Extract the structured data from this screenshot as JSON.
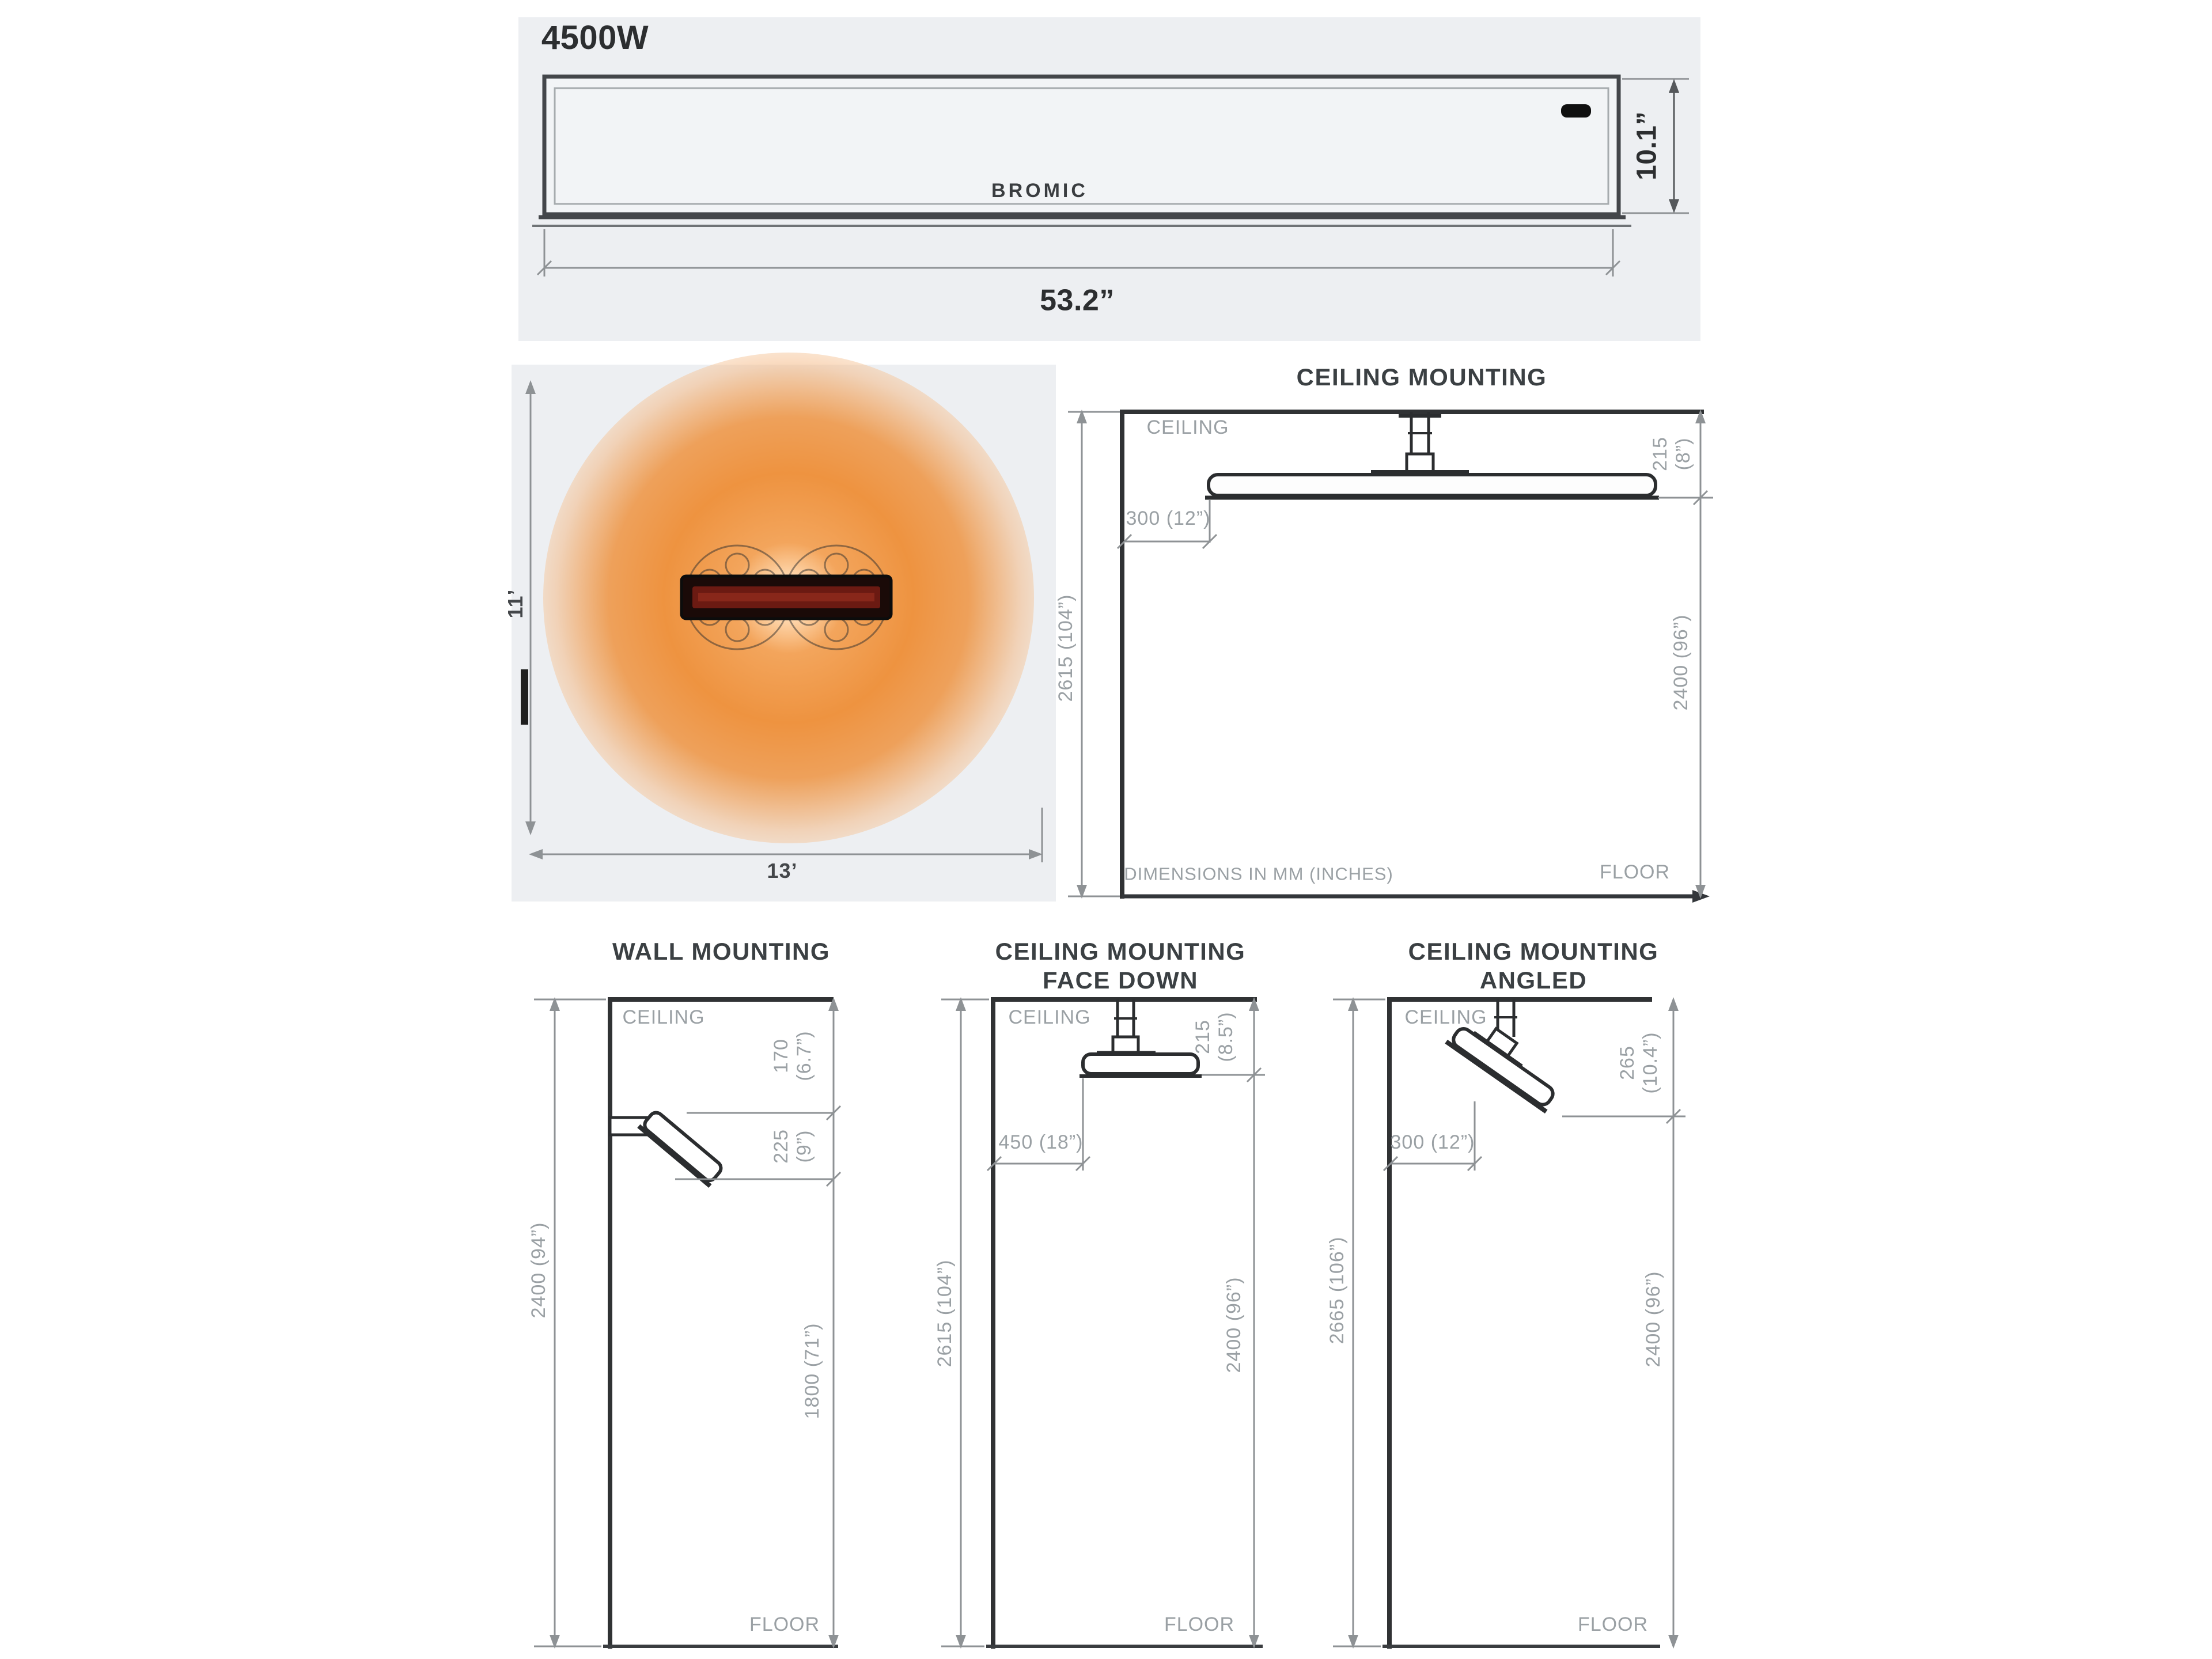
{
  "colors": {
    "panel_bg": "#edeff2",
    "heat_orange": "#ee9340",
    "line_dark": "#303234",
    "line_gray": "#9b9fa2",
    "text_gray": "#9aa0a4",
    "text_dark": "#2c2e30",
    "heater_core_red": "#6b1a12"
  },
  "front_view": {
    "wattage_label": "4500W",
    "brand": "BROMIC",
    "height_dim": "10.1”",
    "width_dim": "53.2”"
  },
  "heat_area": {
    "depth_dim": "11’",
    "width_dim": "13’"
  },
  "cm": {
    "title": "CEILING MOUNTING",
    "ceiling_label": "CEILING",
    "floor_label": "FLOOR",
    "note": "DIMENSIONS IN MM (INCHES)",
    "drop1": "215",
    "drop2": "(8”)",
    "offset": "300 (12”)",
    "total": "2615 (104”)",
    "clearance": "2400 (96”)"
  },
  "wm": {
    "title": "WALL MOUNTING",
    "ceiling_label": "CEILING",
    "floor_label": "FLOOR",
    "top1": "170",
    "top2": "(6.7”)",
    "drop1": "225",
    "drop2": "(9”)",
    "total": "2400 (94”)",
    "clearance": "1800 (71”)"
  },
  "fd": {
    "title1": "CEILING MOUNTING",
    "title2": "FACE DOWN",
    "ceiling_label": "CEILING",
    "floor_label": "FLOOR",
    "drop1": "215",
    "drop2": "(8.5”)",
    "offset": "450 (18”)",
    "total": "2615 (104”)",
    "clearance": "2400 (96”)"
  },
  "ca": {
    "title1": "CEILING MOUNTING",
    "title2": "ANGLED",
    "ceiling_label": "CEILING",
    "floor_label": "FLOOR",
    "drop1": "265",
    "drop2": "(10.4”)",
    "offset": "300 (12”)",
    "total": "2665 (106”)",
    "clearance": "2400 (96”)"
  }
}
